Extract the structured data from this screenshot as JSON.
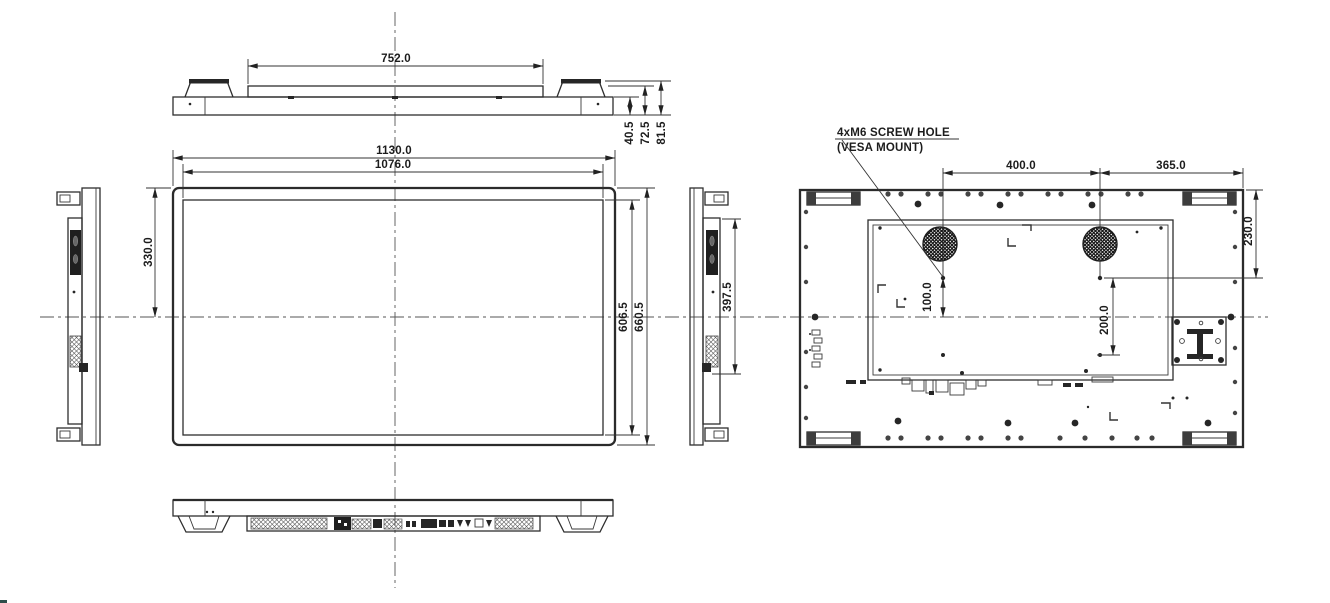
{
  "colors": {
    "ink": "#2b2b2b",
    "background": "#ffffff"
  },
  "views": {
    "top": {
      "dims": {
        "handle_span": "752.0",
        "depth_front": "40.5",
        "depth_body": "72.5",
        "depth_total": "81.5"
      }
    },
    "front": {
      "dims": {
        "outer_width": "1130.0",
        "active_width": "1076.0",
        "top_to_center": "330.0",
        "active_height": "606.5",
        "outer_height": "660.5"
      }
    },
    "side_right": {
      "dims": {
        "terminal_height": "397.5"
      }
    },
    "rear": {
      "note": {
        "line1": "4xM6 SCREW HOLE",
        "line2": "(VESA MOUNT)"
      },
      "dims": {
        "vesa_width": "400.0",
        "vesa_to_edge": "365.0",
        "top_to_vesa": "230.0",
        "vesa_to_center": "100.0",
        "vesa_height": "200.0"
      }
    }
  }
}
